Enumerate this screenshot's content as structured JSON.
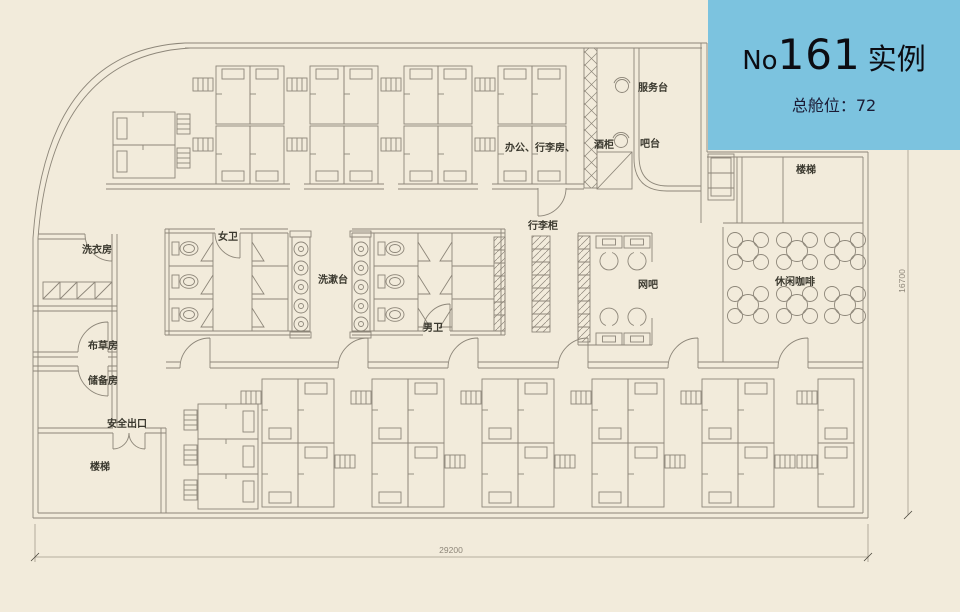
{
  "banner": {
    "prefix": "No",
    "number": "161",
    "suffix": "实例",
    "capacity": "总舱位：72",
    "bg_color": "#7cc3df",
    "title_color": "#0c0c12",
    "subtitle_color": "#1b1b35"
  },
  "labels": {
    "service_desk": "服务台",
    "bar": "吧台",
    "wine_cabinet": "酒柜",
    "office_luggage": "办公、行李房、",
    "luggage_cabinet": "行李柜",
    "womens_toilet": "女卫",
    "wash_area": "洗漱台",
    "mens_toilet": "男卫",
    "internet_cafe": "网吧",
    "leisure_coffee": "休闲咖啡",
    "stairs_top": "楼梯",
    "laundry": "洗衣房",
    "linen_room": "布草房",
    "storage_room": "储备房",
    "emergency_exit": "安全出口",
    "stairs_bottom": "楼梯"
  },
  "dimensions": {
    "width": "29200",
    "height": "16700"
  },
  "colors": {
    "background": "#f2ebdb",
    "line": "#8d8679",
    "label_text": "#3a382e",
    "dim_text": "#8d8679"
  }
}
